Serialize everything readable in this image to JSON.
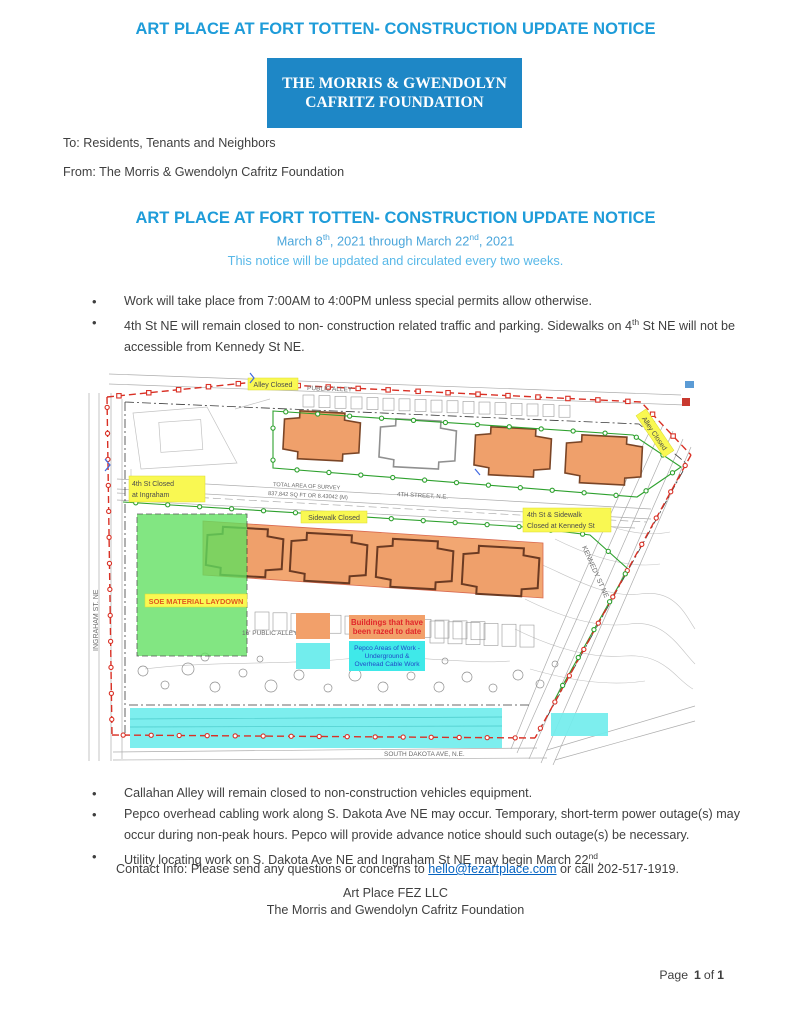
{
  "doc": {
    "title_top": "ART PLACE AT FORT TOTTEN- CONSTRUCTION UPDATE NOTICE",
    "banner": {
      "line1": "THE MORRIS & GWENDOLYN",
      "line2": "CAFRITZ FOUNDATION"
    },
    "to_line": "To: Residents, Tenants and Neighbors",
    "from_line": "From: The Morris & Gwendolyn Cafritz Foundation",
    "heading": "ART PLACE AT FORT TOTTEN- CONSTRUCTION UPDATE NOTICE",
    "date_line": {
      "p1": "March 8",
      "sup1": "th",
      "p2": ", 2021 through March 22",
      "sup2": "nd",
      "p3": ", 2021"
    },
    "update_note": "This notice will be updated and circulated every two weeks.",
    "bullets_top": [
      {
        "p1": "Work will take place from 7:00AM to 4:00PM unless special permits allow otherwise."
      },
      {
        "p1": "4th St NE will remain closed to non- construction related traffic and parking.  Sidewalks on 4",
        "sup": "th",
        "p2": " St NE will not be accessible from Kennedy St NE."
      }
    ],
    "bullets_bottom": [
      {
        "p1": "Callahan Alley will remain closed to non-construction vehicles equipment."
      },
      {
        "p1": "Pepco overhead cabling work along S. Dakota Ave NE may occur.  Temporary, short-term power outage(s) may occur during non-peak hours.  Pepco will provide advance notice should such outage(s) be necessary."
      },
      {
        "p1": "Utility locating work on S. Dakota Ave NE and Ingraham St NE may begin March 22",
        "sup": "nd",
        "p2": "."
      }
    ],
    "contact": {
      "p1": "Contact Info: Please send any questions or concerns to ",
      "email": "hello@fezartplace.com",
      "p2": " or call 202-517-1919."
    },
    "signature": {
      "line1": "Art Place FEZ LLC",
      "line2": "The Morris and Gwendolyn Cafritz Foundation"
    },
    "page_footer": {
      "word_page": "Page",
      "current": "1",
      "word_of": "of",
      "total": "1"
    }
  },
  "map": {
    "street_labels": {
      "public_alley": "PUBLIC ALLEY",
      "fourth_street": "4TH STREET, N.E.",
      "public_alley_16": "16' PUBLIC ALLEY",
      "ingraham": "INGRAHAM ST. NE",
      "kennedy": "KENNEDY ST NE",
      "south_dakota": "SOUTH DAKOTA AVE, N.E.",
      "total_area_1": "TOTAL AREA OF SURVEY",
      "total_area_2": "837,842 SQ FT OR 8.43042 (M)"
    },
    "closure_labels": {
      "alley_closed_top": "Alley Closed",
      "alley_closed_diagonal": "Alley Closed",
      "fourth_closed_line1": "4th St Closed",
      "fourth_closed_line2": "at Ingraham",
      "sidewalk_closed": "Sidewalk Closed",
      "kennedy_closed_line1": "4th St & Sidewalk",
      "kennedy_closed_line2": "Closed at Kennedy St",
      "soe": "SOE MATERIAL LAYDOWN"
    },
    "legend": {
      "razed_line1": "Buildings that have",
      "razed_line2": "been razed to date",
      "pepco_line1": "Pepco Areas of Work -",
      "pepco_line2": "Underground &",
      "pepco_line3": "Overhead Cable Work"
    },
    "colors": {
      "heading_blue": "#1E9CD9",
      "date_blue": "#4BA6DB",
      "subtitle_blue": "#58B8E8",
      "banner_blue": "#1E87C6",
      "link_blue": "#0563C1",
      "razed_orange": "#F2A06A",
      "pepco_cyan": "#72EDED",
      "laydown_green": "#5FE05F",
      "closure_yellow": "#F9F852",
      "boundary_red": "#D93025",
      "fence_green": "#2EA12E"
    }
  }
}
